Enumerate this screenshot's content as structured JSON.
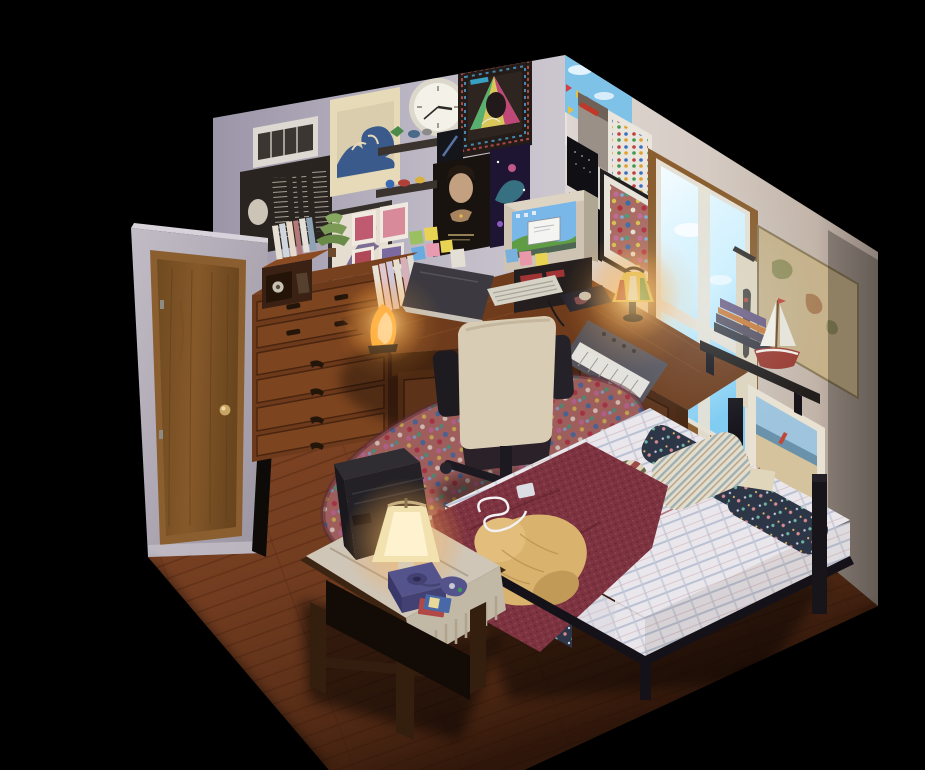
{
  "scene": {
    "title": "Isometric 3D render of a cozy teen bedroom diorama at dusk",
    "style": "low-poly isometric room render, warm lamp light, black void background",
    "clock_time": "2:42"
  },
  "room": {
    "floor": "reddish-brown hardwood planks",
    "left_wall": "pale lavender-grey plaster covered with posters and prints",
    "right_wall": "warm grey plaster with window, map and shelf",
    "entry_wall": "short jutting wall holding a wood-grain door"
  },
  "colors": {
    "background": "#000000",
    "floor": "#7a4123",
    "wall_left": "#b7b2c0",
    "wall_right": "#cfc5bd",
    "wall_door": "#b2acb8",
    "door_wood": "#7d5529",
    "trim_wood": "#8a5e2e",
    "dresser_wood": "#77411f",
    "dresser_side": "#4e2813",
    "desk_wood": "#6e3c1c",
    "desk_front": "#45250f",
    "bed_frame": "#17141a",
    "blanket": "#7d3340",
    "bedding": "#e9e7ec",
    "bolster": "#2c3647",
    "pillow_a": "#cfc0a8",
    "pillow_b": "#d9d2c2",
    "dog": "#d9b26e",
    "rug": "#a96a62",
    "chair": "#d9ccb4",
    "tv": "#232126",
    "gamecube": "#55538c",
    "lamp_glow": "#ffc66e",
    "salt_lamp": "#ffae3c",
    "window_sky": "#bfeaff",
    "monitor_shell": "#cfc4b4",
    "screen_sky": "#79b7e8",
    "screen_grass": "#5f9c44",
    "map": "#c6b189",
    "painting_frame": "#e9e2d2",
    "boat_hull": "#9a3a30",
    "wave_blue": "#3a5a8c"
  },
  "lighting": {
    "sources": [
      "bright daylight window",
      "stained-glass desk lamp",
      "glowing salt lamp",
      "bedside table lamp"
    ]
  },
  "objects": [
    {
      "name": "door",
      "description": "wood-grain interior door with brass knob on jutting entry wall"
    },
    {
      "name": "dresser",
      "description": "tall six-drawer wooden dresser with dark metal pulls"
    },
    {
      "name": "record-player",
      "description": "vintage radio record player sitting on the dresser"
    },
    {
      "name": "dresser-books",
      "description": "row of paperbacks and a leafy potted plant on the dresser top"
    },
    {
      "name": "corner-desk",
      "description": "L-shaped dark wood corner desk with cabinet and drawers"
    },
    {
      "name": "crt-monitor",
      "description": "beige CRT monitor showing a green-hill desktop with an open white dialog"
    },
    {
      "name": "monitor-sticky-notes",
      "description": "blue, pink and yellow sticky notes on the monitor bezel"
    },
    {
      "name": "keyboard",
      "description": "beige computer keyboard on the desk"
    },
    {
      "name": "mouse-pad",
      "description": "dark art mouse pad with mouse"
    },
    {
      "name": "stained-glass-lamp",
      "description": "lit Tiffany-style stained glass lamp on the desk"
    },
    {
      "name": "salt-lamp",
      "description": "glowing amber salt crystal lamp beside desk books"
    },
    {
      "name": "laptop",
      "description": "dark laptop propped open on the left desk section"
    },
    {
      "name": "midi-keyboard",
      "description": "synthesizer keyboard lying on the right desk section"
    },
    {
      "name": "office-chair",
      "description": "cream upholstered swivel chair with black arms and caster base"
    },
    {
      "name": "area-rug",
      "description": "multicolor speckled area rug under the chair"
    },
    {
      "name": "bed",
      "description": "black frame bed along the right wall with plaid bedding"
    },
    {
      "name": "bolster-pillows",
      "description": "navy floral bolster cushions lining the wall side of the bed"
    },
    {
      "name": "striped-pillows",
      "description": "two striped pillows at the head of the bed"
    },
    {
      "name": "knit-blanket",
      "description": "maroon knit blanket across the foot of the bed"
    },
    {
      "name": "sleeping-dog",
      "description": "fluffy golden dog curled asleep on the blanket"
    },
    {
      "name": "music-player",
      "description": "music player with white earbud cord coiled on the blanket"
    },
    {
      "name": "bed-book",
      "description": "cream paperback resting near the bolsters"
    },
    {
      "name": "console-table",
      "description": "ornate wooden table at the foot of the bed with fringed woven runner"
    },
    {
      "name": "crt-tv",
      "description": "black CRT television facing the bed"
    },
    {
      "name": "table-lamp",
      "description": "lit bedside lamp with tapered beige shade"
    },
    {
      "name": "gamecube",
      "description": "indigo game console with controller and game cases"
    },
    {
      "name": "window",
      "description": "oak-framed window glowing with bright blue daylight"
    },
    {
      "name": "world-map",
      "description": "antique world map pinned right of the window"
    },
    {
      "name": "hanging-scroll",
      "description": "narrow hanging scroll print beside the window"
    },
    {
      "name": "wall-shelf",
      "description": "black floating shelf with stacked books and a red model sailboat"
    },
    {
      "name": "seaside-painting",
      "description": "white framed seaside painting above the bed"
    },
    {
      "name": "wall-clock",
      "description": "round white analog wall clock"
    },
    {
      "name": "great-wave-print",
      "description": "Great Wave woodblock print in cream border"
    },
    {
      "name": "vent-grille",
      "description": "white air vent grille high on the left wall"
    },
    {
      "name": "lyrics-poster",
      "description": "wide dark album insert poster with columns of tiny lyrics"
    },
    {
      "name": "framed-album",
      "description": "framed album cover with rainbow geometric border"
    },
    {
      "name": "ring-poster",
      "description": "dark fantasy movie poster with a face and outstretched hand"
    },
    {
      "name": "galaxy-poster",
      "description": "purple space art poster"
    },
    {
      "name": "witch-print",
      "description": "framed flying witch illustration"
    },
    {
      "name": "trinket-shelves",
      "description": "two small wall shelves holding tiny toys"
    },
    {
      "name": "photo-cluster",
      "description": "cluster of small anime photo prints"
    },
    {
      "name": "sticky-cluster",
      "description": "green, yellow, blue and pink sticky notes"
    },
    {
      "name": "calendar",
      "description": "monthly calendar with dark artwork"
    },
    {
      "name": "flags-poster",
      "description": "blue sky poster with rows of colorful flags"
    },
    {
      "name": "space-posters",
      "description": "two small black posters with nebula ring and star text"
    },
    {
      "name": "badge-chart",
      "description": "white chart poster with a grid of tiny colored badges"
    },
    {
      "name": "collage-art",
      "description": "black framed busy multicolor collage artwork"
    }
  ]
}
